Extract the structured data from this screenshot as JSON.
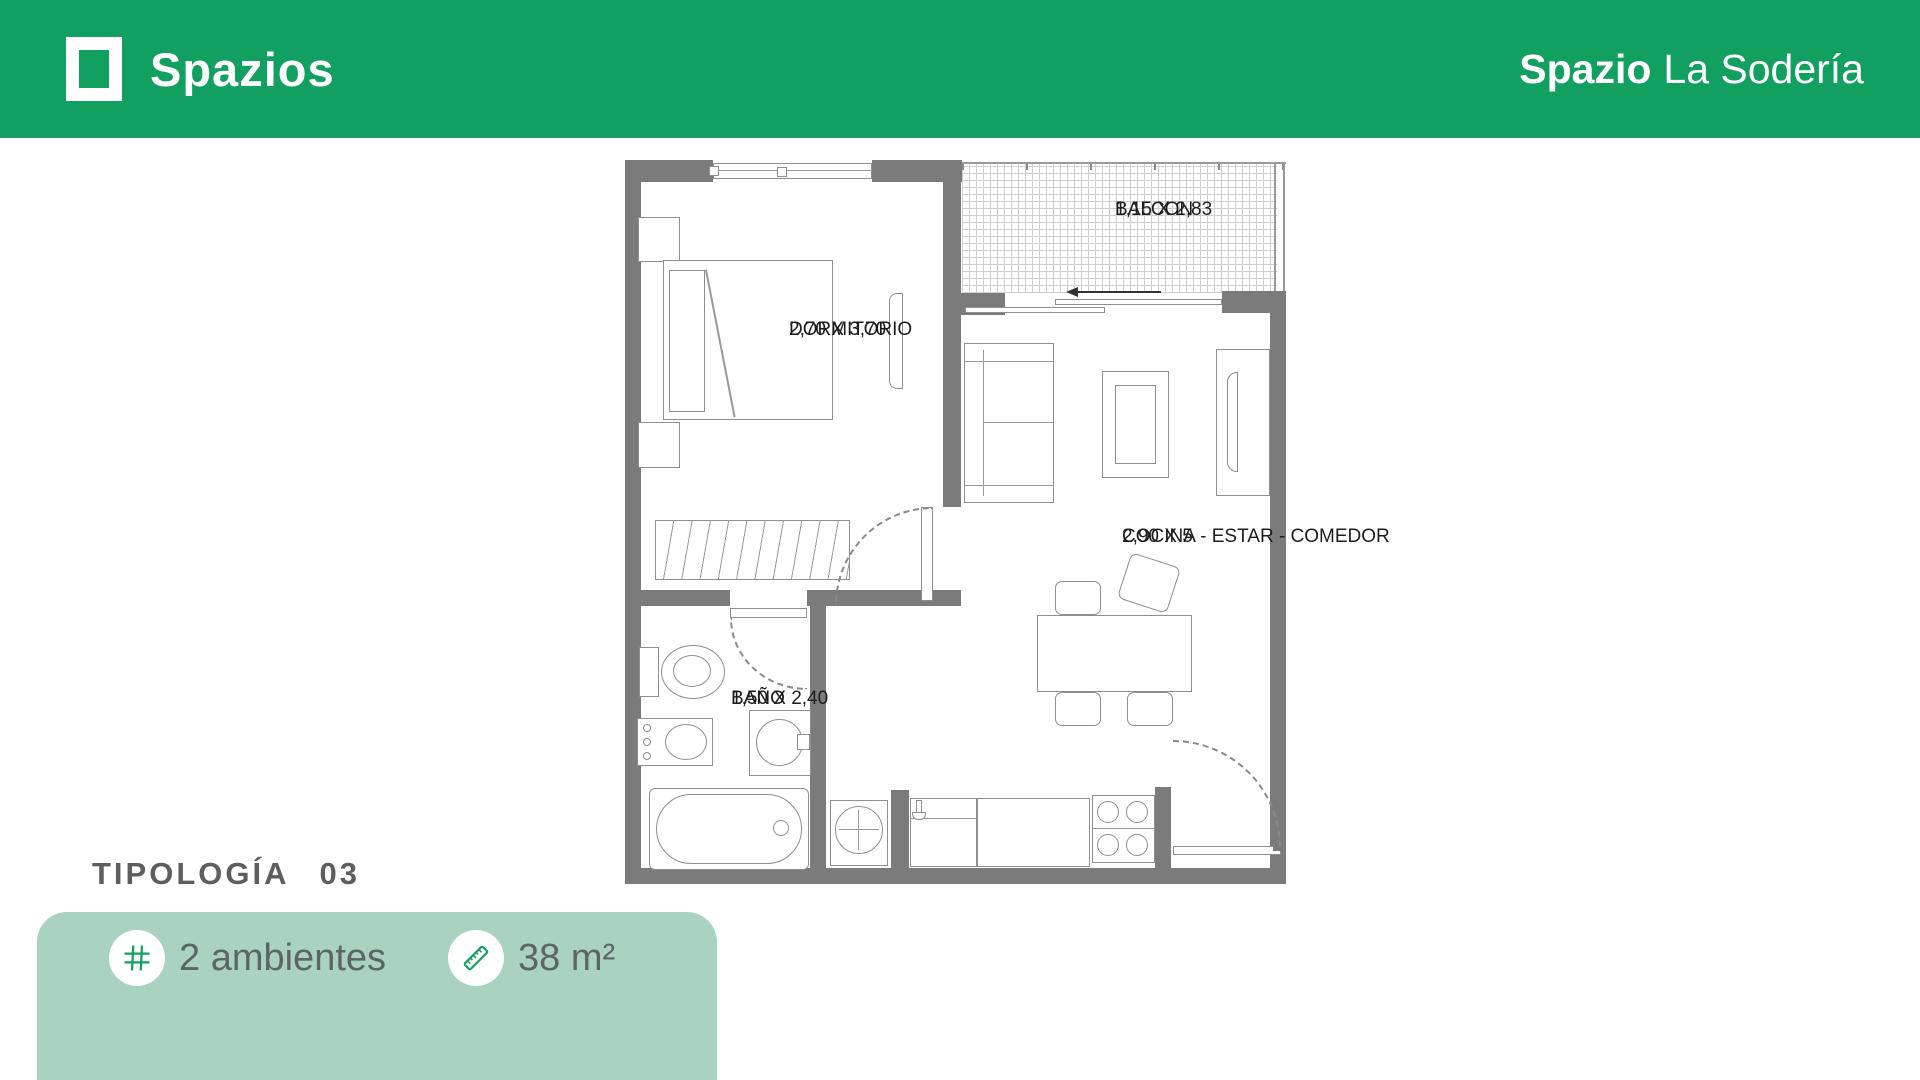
{
  "header": {
    "brand": "Spazios",
    "project_title_bold": "Spazio",
    "project_title_rest": "La Sodería",
    "background_color": "#12A061"
  },
  "plan": {
    "rooms": {
      "dormitorio": {
        "name": "DORMITORIO",
        "dims": "2,70 X 3,70"
      },
      "balcon": {
        "name": "BALCON",
        "dims": "1,15 X 2,83"
      },
      "cocina_estar_comedor": {
        "name": "COCINA - ESTAR - COMEDOR",
        "dims": "2,90 X 5"
      },
      "bano": {
        "name": "BAÑO",
        "dims": "1,50 X 2,40"
      }
    }
  },
  "typology": {
    "title": "TIPOLOGÍA",
    "number": "03"
  },
  "card": {
    "background_color": "#A9D3C0",
    "features": [
      {
        "icon": "grid-icon",
        "label": "2 ambientes"
      },
      {
        "icon": "ruler-icon",
        "label": "38 m²"
      }
    ]
  }
}
